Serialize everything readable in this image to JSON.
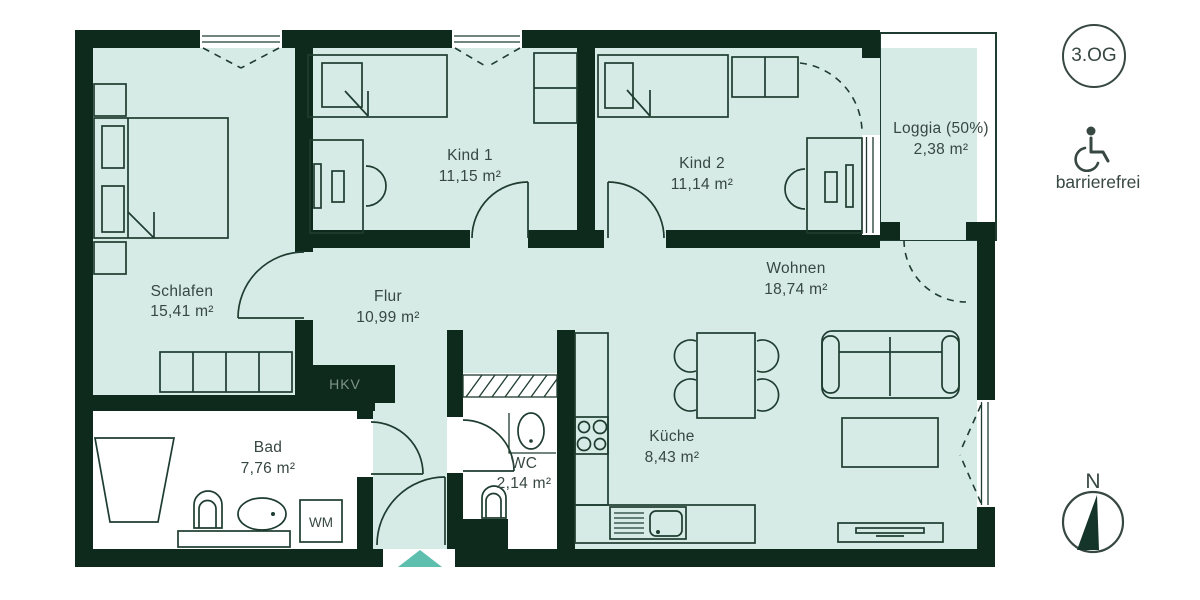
{
  "floor_badge": "3.OG",
  "accessibility_label": "barrierefrei",
  "compass_label": "N",
  "annotations": {
    "hkv": "HKV",
    "wm": "WM"
  },
  "colors": {
    "wall": "#0e2a1c",
    "floor": "#d7ebe6",
    "wet_room_floor": "#ffffff",
    "entrance_arrow": "#5fbfae",
    "text": "#374741"
  },
  "rooms": [
    {
      "name": "Schlafen",
      "area": "15,41 m²"
    },
    {
      "name": "Kind 1",
      "area": "11,15 m²"
    },
    {
      "name": "Kind 2",
      "area": "11,14 m²"
    },
    {
      "name": "Loggia (50%)",
      "area": "2,38 m²"
    },
    {
      "name": "Wohnen",
      "area": "18,74 m²"
    },
    {
      "name": "Flur",
      "area": "10,99 m²"
    },
    {
      "name": "Küche",
      "area": "8,43 m²"
    },
    {
      "name": "Bad",
      "area": "7,76 m²"
    },
    {
      "name": "WC",
      "area": "2,14 m²"
    }
  ]
}
